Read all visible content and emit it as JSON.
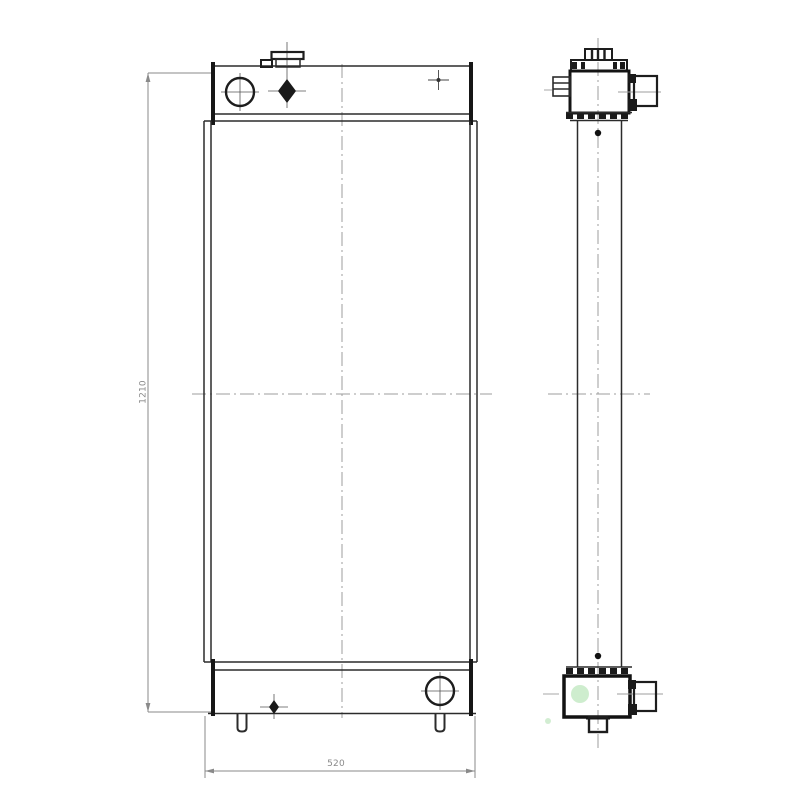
{
  "drawing": {
    "type": "technical-drawing",
    "subject": "radiator-two-view-engineering-drawing",
    "dimensions": {
      "height_label": "1210",
      "width_label": "520"
    },
    "colors": {
      "line": "#2b2b2b",
      "heavy_line": "#141414",
      "centerline": "#9e9e9e",
      "dimension_line": "#8a8a8a",
      "dimension_text": "#8a8a8a",
      "highlight_green": "#c6eac6",
      "background": "#ffffff"
    }
  }
}
